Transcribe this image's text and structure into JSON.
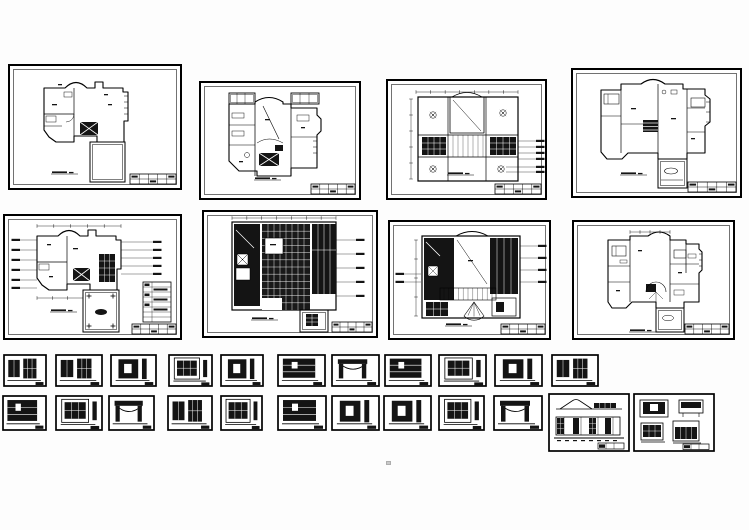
{
  "canvas": {
    "width": 749,
    "height": 530,
    "background": "#fdfdfd",
    "paper": "#ffffff",
    "ink": "#000000",
    "dark_fill": "#141414"
  },
  "sheets": {
    "floor_plan_sheets": [
      {
        "id": "plan-sheet-1",
        "kind": "planA",
        "x": 8,
        "y": 64,
        "w": 174,
        "h": 126
      },
      {
        "id": "plan-sheet-2",
        "kind": "planB",
        "x": 199,
        "y": 81,
        "w": 162,
        "h": 119
      },
      {
        "id": "ceiling-sheet-1",
        "kind": "ceilingA",
        "x": 386,
        "y": 79,
        "w": 161,
        "h": 121
      },
      {
        "id": "plan-sheet-3",
        "kind": "planC",
        "x": 571,
        "y": 68,
        "w": 171,
        "h": 130
      },
      {
        "id": "plan-sheet-4",
        "kind": "planD",
        "x": 3,
        "y": 214,
        "w": 179,
        "h": 126
      },
      {
        "id": "floor-tile-sheet",
        "kind": "tile",
        "x": 202,
        "y": 210,
        "w": 176,
        "h": 128
      },
      {
        "id": "ceiling-sheet-2",
        "kind": "ceilingB",
        "x": 388,
        "y": 220,
        "w": 163,
        "h": 120
      },
      {
        "id": "plan-sheet-5",
        "kind": "planE",
        "x": 572,
        "y": 220,
        "w": 163,
        "h": 120
      }
    ],
    "detail_row_1": [
      {
        "id": "detail-1-1",
        "variant": "A",
        "x": 3,
        "y": 354,
        "w": 44,
        "h": 33
      },
      {
        "id": "detail-1-2",
        "variant": "A",
        "x": 55,
        "y": 354,
        "w": 48,
        "h": 33
      },
      {
        "id": "detail-1-3",
        "variant": "B",
        "x": 110,
        "y": 354,
        "w": 47,
        "h": 33
      },
      {
        "id": "detail-1-4",
        "variant": "E",
        "x": 168,
        "y": 354,
        "w": 45,
        "h": 33
      },
      {
        "id": "detail-1-5",
        "variant": "B",
        "x": 220,
        "y": 354,
        "w": 44,
        "h": 33
      },
      {
        "id": "detail-1-6",
        "variant": "D",
        "x": 277,
        "y": 354,
        "w": 49,
        "h": 33
      },
      {
        "id": "detail-1-7",
        "variant": "C",
        "x": 331,
        "y": 354,
        "w": 49,
        "h": 33
      },
      {
        "id": "detail-1-8",
        "variant": "D",
        "x": 384,
        "y": 354,
        "w": 48,
        "h": 33
      },
      {
        "id": "detail-1-9",
        "variant": "E",
        "x": 438,
        "y": 354,
        "w": 49,
        "h": 33
      },
      {
        "id": "detail-1-10",
        "variant": "B",
        "x": 494,
        "y": 354,
        "w": 49,
        "h": 33
      },
      {
        "id": "detail-1-11",
        "variant": "A",
        "x": 551,
        "y": 354,
        "w": 48,
        "h": 33
      }
    ],
    "detail_row_2": [
      {
        "id": "detail-2-1",
        "variant": "D",
        "x": 2,
        "y": 395,
        "w": 45,
        "h": 36
      },
      {
        "id": "detail-2-2",
        "variant": "E",
        "x": 55,
        "y": 395,
        "w": 48,
        "h": 36
      },
      {
        "id": "detail-2-3",
        "variant": "C",
        "x": 108,
        "y": 395,
        "w": 47,
        "h": 36
      },
      {
        "id": "detail-2-4",
        "variant": "A",
        "x": 167,
        "y": 395,
        "w": 46,
        "h": 36
      },
      {
        "id": "detail-2-5",
        "variant": "E",
        "x": 220,
        "y": 395,
        "w": 43,
        "h": 36
      },
      {
        "id": "detail-2-6",
        "variant": "D",
        "x": 277,
        "y": 395,
        "w": 50,
        "h": 36
      },
      {
        "id": "detail-2-7",
        "variant": "B",
        "x": 331,
        "y": 395,
        "w": 49,
        "h": 36
      },
      {
        "id": "detail-2-8",
        "variant": "B",
        "x": 383,
        "y": 395,
        "w": 49,
        "h": 36
      },
      {
        "id": "detail-2-9",
        "variant": "E",
        "x": 438,
        "y": 395,
        "w": 47,
        "h": 36
      },
      {
        "id": "detail-2-10",
        "variant": "C",
        "x": 493,
        "y": 395,
        "w": 50,
        "h": 36
      }
    ],
    "elevation_sheets": [
      {
        "id": "elevation-sheet-long",
        "kind": "longElev",
        "x": 548,
        "y": 393,
        "w": 82,
        "h": 59
      },
      {
        "id": "elevation-sheet-quad",
        "kind": "quadElev",
        "x": 633,
        "y": 393,
        "w": 82,
        "h": 59
      }
    ],
    "artifact_speck": {
      "x": 386,
      "y": 461
    }
  }
}
